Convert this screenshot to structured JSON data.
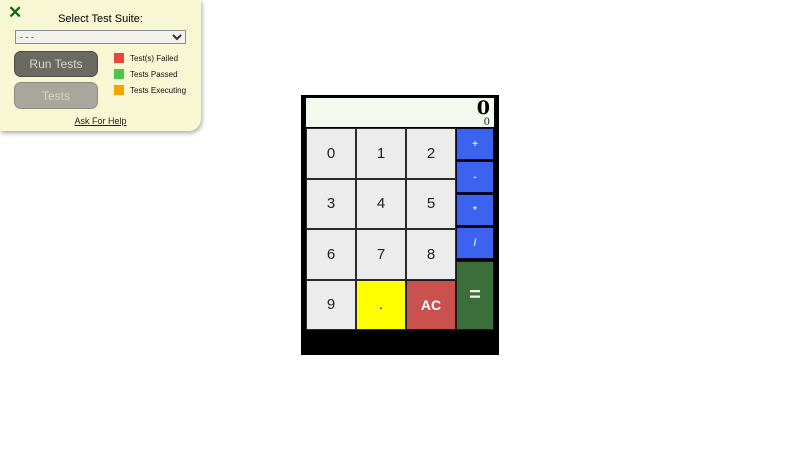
{
  "test_panel": {
    "close_icon": "✕",
    "title": "Select Test Suite:",
    "suite_select": {
      "value": "- - -"
    },
    "run_tests_button": "Run Tests",
    "tests_button": "Tests",
    "legend": [
      {
        "label": "Test(s) Failed",
        "color": "#e8473f"
      },
      {
        "label": "Tests Passed",
        "color": "#4ec44e"
      },
      {
        "label": "Tests Executing",
        "color": "#f4a300"
      }
    ],
    "help_link": "Ask For Help"
  },
  "calculator": {
    "display": {
      "primary": "0",
      "secondary": "0"
    },
    "digits": [
      "0",
      "1",
      "2",
      "3",
      "4",
      "5",
      "6",
      "7",
      "8",
      "9"
    ],
    "decimal": ".",
    "clear": "AC",
    "operators": [
      "+",
      "-",
      "*",
      "/"
    ],
    "equals": "=",
    "colors": {
      "digit_bg": "#ececec",
      "decimal_bg": "#ffff00",
      "clear_bg": "#c9524e",
      "operator_bg": "#3b63f0",
      "equals_bg": "#3c6e3c",
      "display_bg": "#f3f9ef"
    }
  }
}
